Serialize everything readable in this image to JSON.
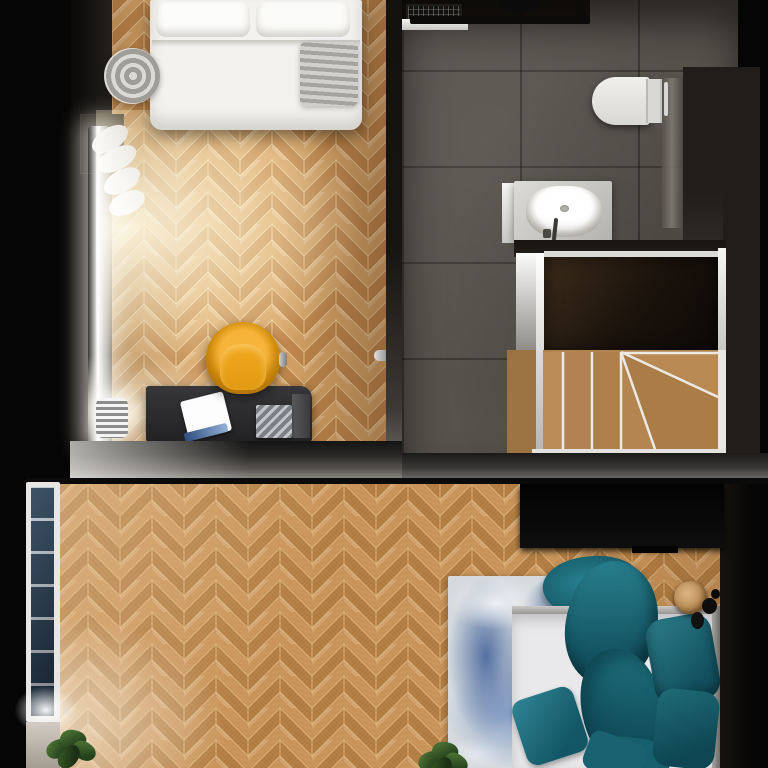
{
  "scene": {
    "type": "top-down 3D render of a two-level apartment floor plan",
    "rooms": [
      {
        "name": "bedroom-office",
        "floor": "herringbone oak parquet",
        "furniture": [
          "single bed with white duvet",
          "gray knit folded blanket",
          "white curtain window with daylight",
          "chrome radiator",
          "yellow swivel chair",
          "black desk",
          "white laptop",
          "book stack"
        ]
      },
      {
        "name": "bathroom",
        "floor": "dark gray stone tile",
        "furniture": [
          "shower with black glass screen and drain grate",
          "black ceiling shower head",
          "wall-hung white toilet",
          "glass partition",
          "white vessel sink on light counter"
        ]
      },
      {
        "name": "stairwell",
        "furniture": [
          "dark walnut landing",
          "oak winder staircase with white stringers"
        ]
      },
      {
        "name": "bedroom-lower",
        "floor": "herringbone oak parquet",
        "furniture": [
          "tall window with blue glass panes",
          "black wardrobe",
          "blue abstract rug",
          "double bed with white mattress and teal bedding",
          "teal pillows and cushions",
          "round wooden side table",
          "black vases",
          "potted plants"
        ]
      }
    ]
  },
  "labels": {
    "stage": "Apartment floor plan – top view 3D render",
    "room_top": "Bedroom / office with herringbone parquet",
    "bed_top": "Single bed with white duvet and pillows",
    "blanket": "Gray knit blanket, rolled end",
    "curtain": "White curtain",
    "window_top": "Window with bright daylight",
    "console": "Dark console at wall",
    "radiator": "Chrome radiator",
    "chair": "Yellow swivel chair",
    "desk": "Black desk",
    "laptop": "Open white laptop",
    "books": "Stack of books",
    "door_handle": "Door handle",
    "bathroom_floor": "Bathroom – dark stone tile floor",
    "shower_grate": "Shower drain grate",
    "shower_screen": "Black framed glass shower screen",
    "shower_head": "Black round shower head",
    "shower_tray": "White shower tray edge",
    "toilet": "Wall-hung toilet",
    "toilet_screen": "Glass partition",
    "sink_counter": "Washbasin counter",
    "sink": "White vessel sink",
    "faucet": "Faucet",
    "landing": "Dark walnut stair landing",
    "stairs": "Oak winder staircase",
    "wall_band": "Interior wall",
    "room_bottom": "Lower bedroom with herringbone parquet",
    "window_bottom": "Tall window with blue panes",
    "wardrobe": "Black wardrobe",
    "rug": "Blue abstract rug",
    "bed_bottom": "Double bed with teal bedding",
    "pillow": "Teal pillow",
    "cushion": "Teal cushion",
    "duvet": "Teal duvet",
    "nightstand": "Round wooden side table",
    "vase": "Black vase",
    "plant": "Potted plant"
  },
  "colors": {
    "parquet_main": "#c9945a",
    "parquet_warm": "#d8a568",
    "bath_tile": "#57524b",
    "walnut_landing": "#2c2014",
    "stair_oak": "#b08351",
    "teal_bedding": "#1f6b7a",
    "chair_yellow": "#e8a020",
    "rug_blue": "#3f639b",
    "wall_dark": "#141414",
    "wall_lit": "#bcb8b4"
  }
}
